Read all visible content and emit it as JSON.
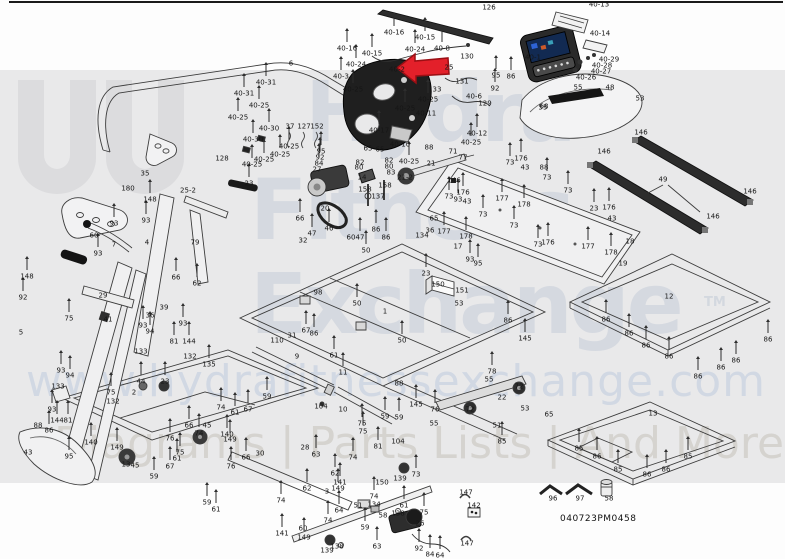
{
  "document": {
    "type": "treadmill exploded parts diagram",
    "code": "040723PM0458"
  },
  "watermark": {
    "line1": "Hydra",
    "line2": "Fitness",
    "line3": "Exchange",
    "tm": "TM",
    "url": "www.hydrafitnessexchange.com",
    "tagline": "Diagrams | Parts Lists | And More",
    "logo": "double-U hydra mark"
  },
  "highlight": {
    "shape": "red-arrow-left",
    "points_at_part": "40-2",
    "color": "#e3202a"
  },
  "colors": {
    "band": "#e9e9ea",
    "watermark_text": "#c6cdd9",
    "line_art": "#3c3c3c",
    "accent_red": "#e3202a"
  },
  "labels": [
    [
      "126",
      489,
      8
    ],
    [
      "40-16",
      394,
      33
    ],
    [
      "40-15",
      425,
      38
    ],
    [
      "40-24",
      415,
      50
    ],
    [
      "40-8",
      442,
      49
    ],
    [
      "40-16",
      347,
      49
    ],
    [
      "40-15",
      372,
      54
    ],
    [
      "40-24",
      356,
      65
    ],
    [
      "40-3",
      341,
      77
    ],
    [
      "40-25",
      353,
      90
    ],
    [
      "40-2",
      397,
      70
    ],
    [
      "25",
      449,
      68
    ],
    [
      "130",
      467,
      57
    ],
    [
      "131",
      462,
      82
    ],
    [
      "95",
      496,
      76
    ],
    [
      "86",
      511,
      77
    ],
    [
      "92",
      495,
      89
    ],
    [
      "33",
      437,
      90
    ],
    [
      "40-6",
      474,
      97
    ],
    [
      "129",
      485,
      104
    ],
    [
      "40-25",
      428,
      100
    ],
    [
      "40-25",
      405,
      109
    ],
    [
      "40-11",
      426,
      114
    ],
    [
      "68",
      544,
      107
    ],
    [
      "40-1",
      533,
      58
    ],
    [
      "40-13",
      599,
      5
    ],
    [
      "40-14",
      600,
      34
    ],
    [
      "40-29",
      609,
      60
    ],
    [
      "40-28",
      602,
      66
    ],
    [
      "40-27",
      601,
      72
    ],
    [
      "40-26",
      586,
      78
    ],
    [
      "55",
      578,
      88
    ],
    [
      "48",
      610,
      88
    ],
    [
      "55",
      562,
      98
    ],
    [
      "53",
      640,
      99
    ],
    [
      "55",
      543,
      108
    ],
    [
      "6",
      291,
      64
    ],
    [
      "40-31",
      266,
      83
    ],
    [
      "40-31",
      244,
      94
    ],
    [
      "40-25",
      259,
      106
    ],
    [
      "40-25",
      238,
      118
    ],
    [
      "37",
      290,
      127
    ],
    [
      "127",
      304,
      127
    ],
    [
      "152",
      317,
      127
    ],
    [
      "40-30",
      269,
      129
    ],
    [
      "40-30",
      253,
      140
    ],
    [
      "40-25",
      289,
      147
    ],
    [
      "40-25",
      280,
      155
    ],
    [
      "40-25",
      264,
      160
    ],
    [
      "40-25",
      252,
      165
    ],
    [
      "128",
      222,
      159
    ],
    [
      "23",
      249,
      184
    ],
    [
      "35",
      145,
      174
    ],
    [
      "180",
      128,
      189
    ],
    [
      "148",
      150,
      200
    ],
    [
      "25-2",
      188,
      191
    ],
    [
      "93",
      146,
      221
    ],
    [
      "93",
      114,
      224
    ],
    [
      "60",
      94,
      236
    ],
    [
      "7",
      114,
      245
    ],
    [
      "4",
      147,
      243
    ],
    [
      "79",
      195,
      243
    ],
    [
      "54",
      77,
      258
    ],
    [
      "93",
      98,
      254
    ],
    [
      "148",
      27,
      277
    ],
    [
      "66",
      176,
      278
    ],
    [
      "62",
      197,
      284
    ],
    [
      "92",
      23,
      298
    ],
    [
      "29",
      103,
      296
    ],
    [
      "39",
      164,
      308
    ],
    [
      "36",
      150,
      316
    ],
    [
      "41",
      108,
      320
    ],
    [
      "75",
      69,
      319
    ],
    [
      "5",
      21,
      333
    ],
    [
      "93",
      143,
      326
    ],
    [
      "94",
      150,
      332
    ],
    [
      "93",
      183,
      324
    ],
    [
      "81",
      174,
      342
    ],
    [
      "144",
      189,
      342
    ],
    [
      "133",
      141,
      352
    ],
    [
      "132",
      190,
      357
    ],
    [
      "135",
      209,
      365
    ],
    [
      "95",
      321,
      152
    ],
    [
      "92",
      320,
      158
    ],
    [
      "84",
      319,
      164
    ],
    [
      "27",
      317,
      170
    ],
    [
      "20",
      325,
      209
    ],
    [
      "65",
      368,
      149
    ],
    [
      "65",
      380,
      150
    ],
    [
      "82",
      360,
      163
    ],
    [
      "80",
      359,
      168
    ],
    [
      "82",
      389,
      161
    ],
    [
      "80",
      389,
      167
    ],
    [
      "83",
      391,
      173
    ],
    [
      "14",
      362,
      178
    ],
    [
      "158",
      365,
      190
    ],
    [
      "158",
      385,
      186
    ],
    [
      "137",
      378,
      197
    ],
    [
      "40-17",
      379,
      131
    ],
    [
      "40-10",
      400,
      145
    ],
    [
      "88",
      429,
      148
    ],
    [
      "40-25",
      409,
      162
    ],
    [
      "21",
      431,
      164
    ],
    [
      "71",
      453,
      152
    ],
    [
      "77",
      463,
      158
    ],
    [
      "21-2",
      405,
      178
    ],
    [
      "146",
      454,
      181
    ],
    [
      "93",
      458,
      200
    ],
    [
      "40-12",
      477,
      134
    ],
    [
      "40-25",
      471,
      143
    ],
    [
      "66",
      300,
      219
    ],
    [
      "47",
      312,
      234
    ],
    [
      "46",
      329,
      229
    ],
    [
      "32",
      303,
      241
    ],
    [
      "60",
      351,
      238
    ],
    [
      "47",
      360,
      238
    ],
    [
      "50",
      366,
      251
    ],
    [
      "86",
      376,
      230
    ],
    [
      "86",
      386,
      238
    ],
    [
      "36",
      430,
      231
    ],
    [
      "134",
      422,
      236
    ],
    [
      "65",
      434,
      219
    ],
    [
      "23",
      426,
      274
    ],
    [
      "17",
      458,
      247
    ],
    [
      "93",
      470,
      260
    ],
    [
      "95",
      478,
      264
    ],
    [
      "151",
      462,
      291
    ],
    [
      "150",
      438,
      285
    ],
    [
      "98",
      318,
      293
    ],
    [
      "31",
      292,
      336
    ],
    [
      "110",
      277,
      341
    ],
    [
      "67",
      306,
      331
    ],
    [
      "86",
      314,
      334
    ],
    [
      "1",
      385,
      312
    ],
    [
      "50",
      357,
      304
    ],
    [
      "50",
      402,
      341
    ],
    [
      "53",
      459,
      304
    ],
    [
      "86",
      508,
      321
    ],
    [
      "145",
      525,
      339
    ],
    [
      "73",
      510,
      163
    ],
    [
      "176",
      521,
      159
    ],
    [
      "43",
      525,
      168
    ],
    [
      "88",
      544,
      168
    ],
    [
      "73",
      547,
      178
    ],
    [
      "73",
      568,
      191
    ],
    [
      "176",
      463,
      193
    ],
    [
      "73",
      449,
      197
    ],
    [
      "43",
      467,
      202
    ],
    [
      "177",
      502,
      199
    ],
    [
      "178",
      524,
      205
    ],
    [
      "73",
      483,
      215
    ],
    [
      "73",
      514,
      226
    ],
    [
      "177",
      444,
      232
    ],
    [
      "178",
      466,
      237
    ],
    [
      "73",
      538,
      245
    ],
    [
      "176",
      548,
      243
    ],
    [
      "177",
      588,
      247
    ],
    [
      "178",
      611,
      253
    ],
    [
      "146",
      641,
      133
    ],
    [
      "146",
      604,
      152
    ],
    [
      "49",
      663,
      180
    ],
    [
      "146",
      750,
      192
    ],
    [
      "146",
      713,
      217
    ],
    [
      "23",
      594,
      209
    ],
    [
      "176",
      609,
      208
    ],
    [
      "43",
      612,
      219
    ],
    [
      "18",
      630,
      242
    ],
    [
      "19",
      623,
      264
    ],
    [
      "12",
      669,
      297
    ],
    [
      "86",
      606,
      320
    ],
    [
      "86",
      629,
      334
    ],
    [
      "86",
      646,
      346
    ],
    [
      "86",
      669,
      357
    ],
    [
      "86",
      698,
      377
    ],
    [
      "86",
      721,
      368
    ],
    [
      "86",
      736,
      361
    ],
    [
      "86",
      768,
      340
    ],
    [
      "13",
      653,
      414
    ],
    [
      "85",
      579,
      449
    ],
    [
      "86",
      597,
      457
    ],
    [
      "85",
      618,
      470
    ],
    [
      "86",
      647,
      475
    ],
    [
      "86",
      666,
      470
    ],
    [
      "85",
      688,
      457
    ],
    [
      "96",
      553,
      499
    ],
    [
      "97",
      580,
      499
    ],
    [
      "58",
      609,
      499
    ],
    [
      "9",
      297,
      357
    ],
    [
      "61",
      334,
      356
    ],
    [
      "11",
      343,
      373
    ],
    [
      "59",
      267,
      397
    ],
    [
      "74",
      221,
      408
    ],
    [
      "67",
      248,
      410
    ],
    [
      "61",
      235,
      413
    ],
    [
      "104",
      321,
      407
    ],
    [
      "10",
      343,
      410
    ],
    [
      "45",
      207,
      426
    ],
    [
      "66",
      189,
      426
    ],
    [
      "74",
      199,
      434
    ],
    [
      "140",
      227,
      435
    ],
    [
      "149",
      230,
      440
    ],
    [
      "66",
      246,
      458
    ],
    [
      "76",
      231,
      467
    ],
    [
      "30",
      260,
      454
    ],
    [
      "28",
      305,
      448
    ],
    [
      "63",
      316,
      455
    ],
    [
      "75",
      362,
      424
    ],
    [
      "62",
      335,
      474
    ],
    [
      "74",
      353,
      458
    ],
    [
      "3",
      327,
      492
    ],
    [
      "74",
      281,
      501
    ],
    [
      "62",
      307,
      489
    ],
    [
      "141",
      340,
      483
    ],
    [
      "149",
      338,
      489
    ],
    [
      "60",
      303,
      529
    ],
    [
      "141",
      282,
      534
    ],
    [
      "149",
      304,
      538
    ],
    [
      "139",
      327,
      551
    ],
    [
      "138",
      337,
      547
    ],
    [
      "74",
      328,
      521
    ],
    [
      "64",
      339,
      511
    ],
    [
      "51",
      358,
      506
    ],
    [
      "134",
      374,
      505
    ],
    [
      "74",
      374,
      497
    ],
    [
      "58",
      383,
      516
    ],
    [
      "59",
      365,
      528
    ],
    [
      "63",
      377,
      547
    ],
    [
      "150",
      382,
      483
    ],
    [
      "139",
      400,
      479
    ],
    [
      "73",
      416,
      475
    ],
    [
      "61",
      404,
      506
    ],
    [
      "138",
      398,
      514
    ],
    [
      "75",
      424,
      513
    ],
    [
      "26",
      420,
      524
    ],
    [
      "92",
      419,
      549
    ],
    [
      "84",
      430,
      555
    ],
    [
      "64",
      440,
      556
    ],
    [
      "147",
      466,
      493
    ],
    [
      "142",
      474,
      506
    ],
    [
      "147",
      467,
      544
    ],
    [
      "59",
      207,
      503
    ],
    [
      "61",
      216,
      510
    ],
    [
      "93",
      61,
      371
    ],
    [
      "94",
      70,
      376
    ],
    [
      "133",
      58,
      387
    ],
    [
      "75",
      111,
      393
    ],
    [
      "132",
      113,
      402
    ],
    [
      "2",
      134,
      393
    ],
    [
      "93",
      52,
      410
    ],
    [
      "144",
      57,
      421
    ],
    [
      "81",
      68,
      421
    ],
    [
      "44",
      141,
      382
    ],
    [
      "23",
      165,
      382
    ],
    [
      "88",
      38,
      426
    ],
    [
      "86",
      49,
      431
    ],
    [
      "43",
      28,
      453
    ],
    [
      "95",
      69,
      457
    ],
    [
      "140",
      91,
      443
    ],
    [
      "149",
      117,
      448
    ],
    [
      "13",
      126,
      465
    ],
    [
      "45",
      135,
      466
    ],
    [
      "76",
      170,
      439
    ],
    [
      "75",
      180,
      453
    ],
    [
      "61",
      177,
      459
    ],
    [
      "67",
      170,
      467
    ],
    [
      "59",
      154,
      477
    ],
    [
      "78",
      492,
      372
    ],
    [
      "55",
      489,
      380
    ],
    [
      "72",
      519,
      387
    ],
    [
      "22",
      502,
      398
    ],
    [
      "72",
      470,
      410
    ],
    [
      "51",
      497,
      426
    ],
    [
      "85",
      502,
      442
    ],
    [
      "53",
      525,
      409
    ],
    [
      "65",
      549,
      415
    ],
    [
      "145",
      416,
      405
    ],
    [
      "76",
      435,
      410
    ],
    [
      "55",
      434,
      424
    ],
    [
      "59",
      385,
      417
    ],
    [
      "59",
      399,
      418
    ],
    [
      "75",
      363,
      432
    ],
    [
      "81",
      378,
      447
    ],
    [
      "104",
      398,
      442
    ],
    [
      "88",
      399,
      384
    ]
  ],
  "bolt_parts": [
    "73",
    "74",
    "75",
    "85",
    "86",
    "40-25",
    "93",
    "94",
    "63",
    "62",
    "61",
    "59",
    "64",
    "50",
    "47",
    "46",
    "81",
    "23",
    "44",
    "135",
    "140",
    "141",
    "144",
    "148",
    "149",
    "176",
    "177",
    "178",
    "40-31",
    "40-30",
    "40-24",
    "40-16",
    "40-15",
    "40-8",
    "40-3",
    "40-12",
    "40-17",
    "11",
    "66",
    "67",
    "78",
    "145",
    "76",
    "95",
    "92",
    "84"
  ]
}
